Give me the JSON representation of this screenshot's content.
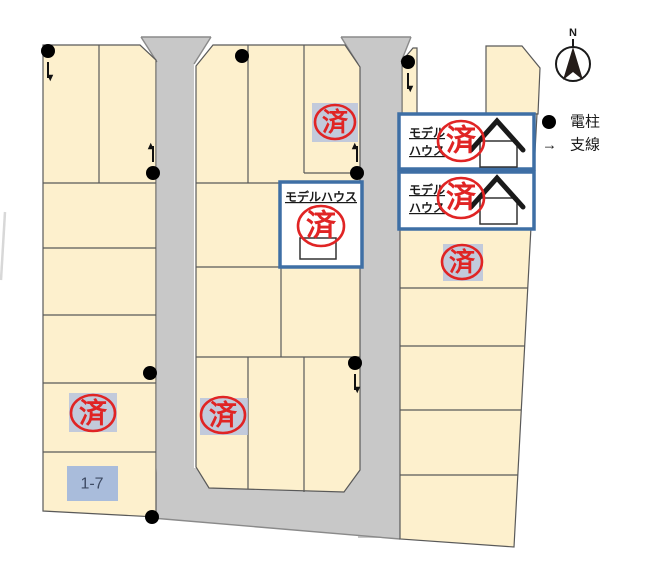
{
  "title": "housing-subdivision-lot-map",
  "compass": {
    "north_label": "N"
  },
  "legend": {
    "pole_symbol": "●",
    "pole_label": "電柱",
    "guy_symbol": "→",
    "guy_label": "支線"
  },
  "stamp": {
    "sold_label": "済"
  },
  "model_house": {
    "two_line_1": "モデル",
    "two_line_2": "ハウス",
    "one_line": "モデルハウス"
  },
  "lot_labels": {
    "lot_1_7": "1-7"
  },
  "counts": {
    "sold_stamps": 7,
    "utility_poles": 8,
    "model_house_boxes": 3
  },
  "colors": {
    "lot_fill": "#fdf0cd",
    "road_fill": "#c8c8c8",
    "model_house_border": "#3e6fa5",
    "stamp_red": "#e02424",
    "stamp_bg": "#b7c3dd",
    "lot_label_bg": "#a9bcdb"
  }
}
